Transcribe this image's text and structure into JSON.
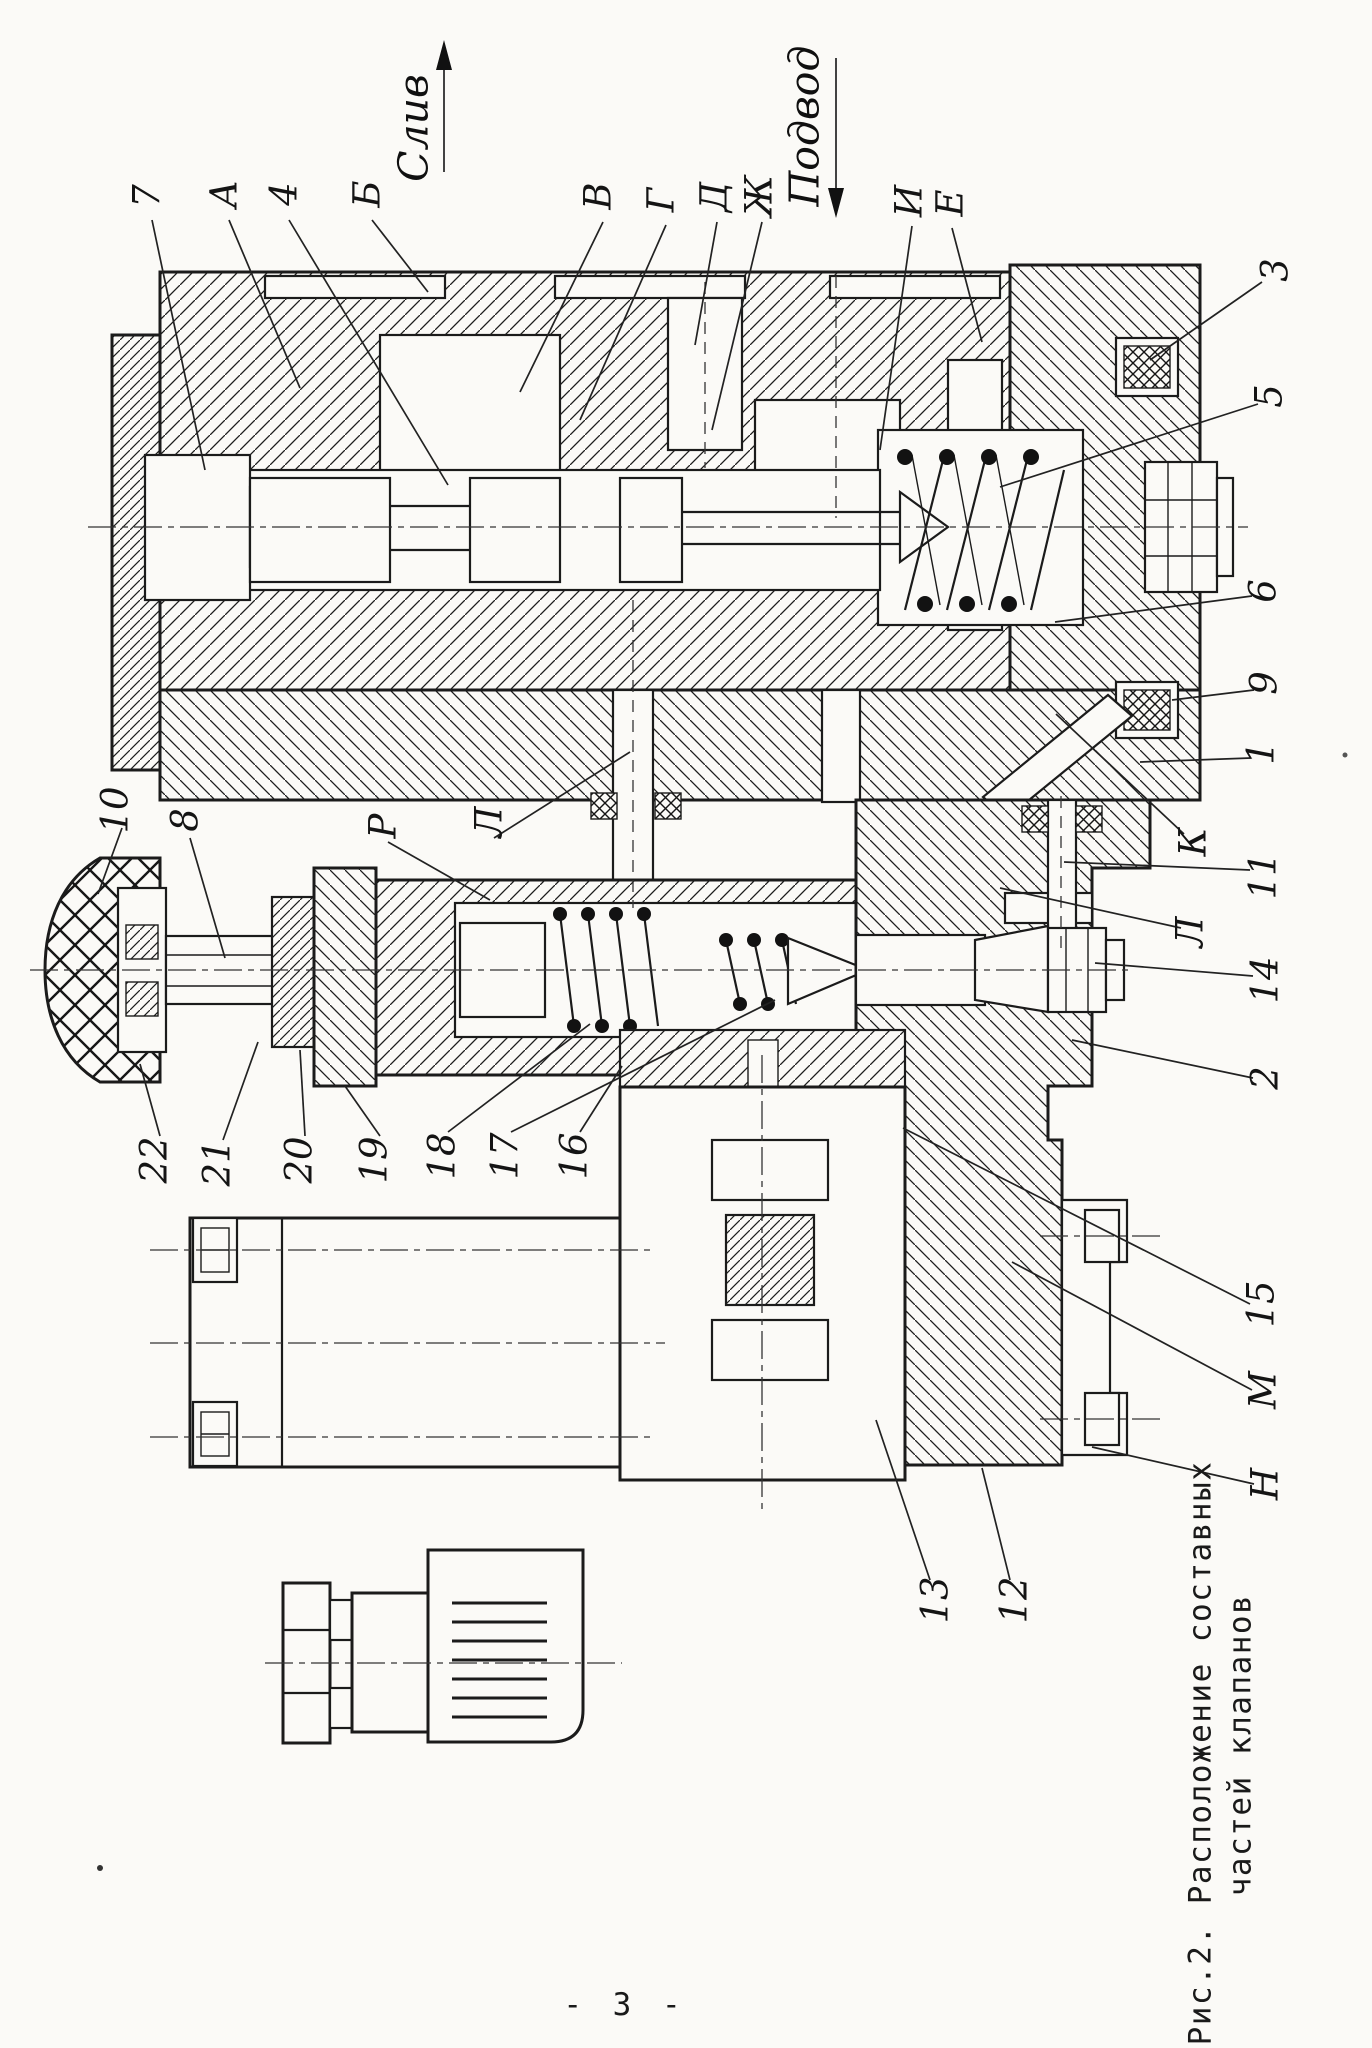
{
  "page": {
    "number": "- 3 -"
  },
  "caption": {
    "line1": "Рис.2. Расположение составных",
    "line2": "частей клапанов"
  },
  "flow": {
    "drain": "Слив",
    "supply": "Подвод"
  },
  "callouts": {
    "c7": "7",
    "cA": "А",
    "c4": "4",
    "cB": "Б",
    "cV": "В",
    "cG": "Г",
    "cD": "Д",
    "cZh": "Ж",
    "cI": "И",
    "cE": "Е",
    "c3": "3",
    "c5": "5",
    "c6": "6",
    "c9": "9",
    "c1": "1",
    "cK": "К",
    "c11": "11",
    "cLr": "Л",
    "c14": "14",
    "c2": "2",
    "c15": "15",
    "cM": "М",
    "cN": "Н",
    "c13": "13",
    "c12": "12",
    "c10": "10",
    "c8": "8",
    "cP": "Р",
    "cLl": "Л",
    "c22": "22",
    "c21": "21",
    "c20": "20",
    "c19": "19",
    "c18": "18",
    "c17": "17",
    "c16": "16"
  }
}
